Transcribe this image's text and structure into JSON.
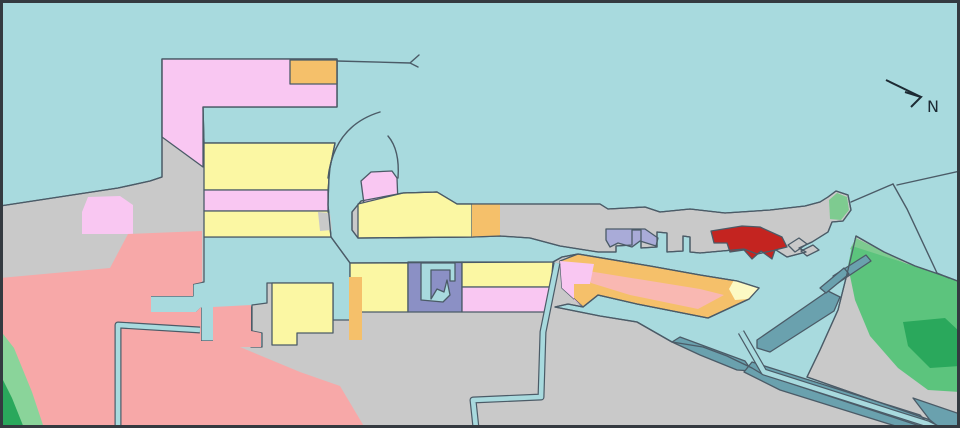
{
  "map": {
    "type": "harbor-zoning-map",
    "compass": {
      "label": "N",
      "shaft_d": "M886,80 L921,97",
      "head_d": "M905,92 L921,97 L911,107",
      "label_x": 927,
      "label_y": 112
    },
    "palette": {
      "water": "#a8dade",
      "land": "#c9c9c9",
      "outline": "#4b5b67",
      "frame": "#343a40",
      "pink": "#f9c7f2",
      "salmon": "#f7a8a8",
      "salmon_light": "#f9b8b2",
      "yellow": "#fbf7a3",
      "yellow_pale": "#fcf9c4",
      "orange": "#f5c06a",
      "slate": "#8b90c5",
      "purple": "#a9abd8",
      "red": "#c42420",
      "teal": "#6aa1ae",
      "green_light": "#8ad49a",
      "green_med": "#5cc47d",
      "green_dark": "#2aa85c",
      "green_strip": "#7ecb90",
      "north_ink": "#1d2a33"
    },
    "regions": [
      {
        "name": "mainland-west",
        "fill": "land",
        "stroke": true,
        "points": "0,206 118,188 150,181 162,177 162,59 337,59 337,107 203,107 204,143 335,143 329,172 328,205 331,237 350,263 553,262 562,257 578,254 650,266 700,275 737,281 759,288 749,299 708,318 637,304 598,295 583,307 568,304 555,307 600,316 637,322 672,342 703,347 727,356 752,368 762,374 926,428 0,428"
      },
      {
        "name": "north-pier",
        "fill": "land",
        "stroke": true,
        "points": "352,230 352,212 361,201 403,193 437,192 457,204 600,204 608,209 645,207 660,212 690,209 725,213 770,210 805,206 820,202 828,197 836,191 848,195 851,210 843,221 832,222 828,232 812,242 799,248 806,252 787,257 776,250 757,254 744,249 700,253 690,252 690,237 683,236 683,251 667,252 667,233 657,232 657,247 641,248 641,230 632,230 632,245 616,246 616,252 598,252 560,246 530,238 500,236 473,237 358,238"
      },
      {
        "name": "islet-east-1",
        "fill": "land",
        "stroke": true,
        "points": "788,245 799,238 807,244 795,252"
      },
      {
        "name": "islet-east-2",
        "fill": "land",
        "stroke": true,
        "points": "801,251 813,245 819,250 807,256"
      },
      {
        "name": "land-southeast",
        "fill": "land",
        "stroke": true,
        "points": "856,236 884,252 915,266 947,277 960,282 960,428 940,428 930,420 807,377 820,350 838,310 848,270"
      },
      {
        "name": "pier-head-pink-cap",
        "fill": "pink",
        "stroke": true,
        "points": "364,204 361,181 371,172 392,171 397,178 398,204"
      },
      {
        "name": "inner-basin-water",
        "fill": "water",
        "stroke": true,
        "points": "204,237 331,237 350,263 350,320 333,320 333,283 267,283 267,303 252,305 252,331 262,333 262,347 251,347 251,307 214,308 214,341 201,341 201,308 196,313 150,313 150,296 193,296 193,284 204,282"
      },
      {
        "name": "zone-pink-gamma",
        "fill": "pink",
        "stroke": true,
        "points": "162,59 337,59 337,107 203,107 203,167 162,137"
      },
      {
        "name": "zone-orange-top",
        "fill": "orange",
        "stroke": true,
        "points": "290,60 337,60 337,84 290,84"
      },
      {
        "name": "zone-yellow-band-1",
        "fill": "yellow",
        "stroke": true,
        "points": "204,143 335,143 330,168 328,190 204,190"
      },
      {
        "name": "zone-pink-band",
        "fill": "pink",
        "stroke": true,
        "points": "204,190 328,190 328,211 204,211"
      },
      {
        "name": "zone-yellow-band-2",
        "fill": "yellow",
        "stroke": true,
        "points": "204,211 328,211 331,237 204,237"
      },
      {
        "name": "gray-wedge-small",
        "fill": "land",
        "stroke": false,
        "points": "318,212 330,213 332,230 320,231"
      },
      {
        "name": "zone-pink-patch-west",
        "fill": "pink",
        "stroke": false,
        "points": "88,197 120,196 133,205 133,234 82,234 82,212"
      },
      {
        "name": "zone-salmon-main",
        "fill": "salmon",
        "stroke": false,
        "points": "0,278 110,268 128,234 202,231 202,282 193,284 193,296 151,296 151,312 196,312 201,307 201,341 213,341 213,307 251,305 251,331 261,333 261,347 240,347 300,372 340,386 365,428 0,428"
      },
      {
        "name": "green-hill-sw-light",
        "fill": "green_light",
        "stroke": false,
        "points": "0,330 14,348 32,392 44,428 0,428"
      },
      {
        "name": "green-hill-sw-dark",
        "fill": "green_dark",
        "stroke": false,
        "points": "0,374 12,398 24,428 0,428"
      },
      {
        "name": "zone-yellow-block-a",
        "fill": "yellow",
        "stroke": true,
        "points": "272,283 333,283 333,333 297,333 297,345 272,345"
      },
      {
        "name": "zone-yellow-block-c",
        "fill": "yellow",
        "stroke": true,
        "points": "350,263 408,263 408,312 350,312"
      },
      {
        "name": "zone-orange-strip",
        "fill": "orange",
        "stroke": false,
        "points": "349,277 362,277 362,340 349,340"
      },
      {
        "name": "zone-slate-block",
        "fill": "slate",
        "stroke": true,
        "points": "408,262 462,262 462,312 408,312"
      },
      {
        "name": "slate-dock-notch-water",
        "fill": "water",
        "stroke": true,
        "points": "421,263 455,263 455,281 450,281 450,270 431,270 431,299 437,289 444,292 447,280 450,295 443,302 421,300"
      },
      {
        "name": "zone-yellow-block-e",
        "fill": "yellow",
        "stroke": true,
        "points": "462,262 553,262 551,287 462,287"
      },
      {
        "name": "zone-pink-block-f",
        "fill": "pink",
        "stroke": true,
        "points": "462,287 551,287 547,312 462,312"
      },
      {
        "name": "diagonal-pier-orange",
        "fill": "orange",
        "stroke": true,
        "points": "560,261 578,254 650,266 700,275 737,281 759,288 749,299 708,318 637,304 598,295 583,307 562,288"
      },
      {
        "name": "diagonal-pier-salmon",
        "fill": "salmon_light",
        "stroke": false,
        "points": "588,271 700,289 724,295 698,309 630,295 591,283"
      },
      {
        "name": "diagonal-pier-pink-end",
        "fill": "pink",
        "stroke": false,
        "points": "560,261 594,264 590,284 574,284 574,300 583,307 562,288"
      },
      {
        "name": "diagonal-pier-yellow-tip",
        "fill": "yellow_pale",
        "stroke": false,
        "points": "734,280 759,288 749,299 735,300 729,289"
      },
      {
        "name": "north-pier-yellow",
        "fill": "yellow",
        "stroke": true,
        "points": "358,204 403,193 437,192 457,204 472,204 472,237 358,238"
      },
      {
        "name": "north-pier-orange",
        "fill": "orange",
        "stroke": false,
        "points": "472,204 500,204 500,236 472,237"
      },
      {
        "name": "zone-purple-docks",
        "fill": "purple",
        "stroke": true,
        "points": "606,229 645,229 658,238 656,246 640,241 632,247 618,243 610,247 606,240"
      },
      {
        "name": "zone-red-terminal",
        "fill": "red",
        "stroke": true,
        "points": "711,231 742,226 760,227 782,237 787,247 775,250 772,259 761,251 752,259 744,250 730,252 727,243 714,243"
      },
      {
        "name": "green-spit-strip",
        "fill": "green_strip",
        "stroke": false,
        "points": "830,219 829,200 837,193 847,197 849,210 841,220"
      },
      {
        "name": "green-strip-ne-coast",
        "fill": "green_strip",
        "stroke": false,
        "points": "856,238 905,263 896,273 850,249"
      },
      {
        "name": "green-hill-se-med",
        "fill": "green_med",
        "stroke": false,
        "points": "852,246 905,263 947,277 960,283 960,392 928,390 898,368 870,336 855,300 848,266"
      },
      {
        "name": "green-hill-se-dark",
        "fill": "green_dark",
        "stroke": false,
        "points": "903,322 945,318 960,332 960,366 930,368 908,346"
      },
      {
        "name": "teal-revetment-wedge",
        "fill": "teal",
        "stroke": true,
        "points": "672,342 680,337 745,361 752,371 737,370 700,355"
      },
      {
        "name": "teal-breakwater-band",
        "fill": "teal",
        "stroke": true,
        "points": "757,340 828,291 840,297 834,311 770,352 757,348"
      },
      {
        "name": "teal-finger-pier-1",
        "fill": "teal",
        "stroke": true,
        "points": "833,276 866,255 871,261 838,283"
      },
      {
        "name": "teal-finger-pier-2",
        "fill": "teal",
        "stroke": true,
        "points": "820,288 844,268 849,274 826,293"
      },
      {
        "name": "teal-canal-bank-south",
        "fill": "teal",
        "stroke": true,
        "points": "752,362 920,415 932,428 902,428 780,390 744,372"
      },
      {
        "name": "teal-corner-se",
        "fill": "teal",
        "stroke": true,
        "points": "913,398 960,414 960,428 936,428"
      }
    ],
    "restroke": [
      {
        "name": "mainland-west-coastline",
        "ref": "mainland-west"
      },
      {
        "name": "north-pier-coastline",
        "ref": "north-pier"
      },
      {
        "name": "land-southeast-coastline",
        "ref": "land-southeast"
      }
    ],
    "canals": [
      {
        "name": "canal-south-central",
        "d": "M557,263 L543,332 L541,397 L473,400 L476,428"
      },
      {
        "name": "canal-west",
        "d": "M118,428 L118,325 L200,330"
      },
      {
        "name": "canal-southeast",
        "d": "M741,332 L764,372 L928,424 L936,428"
      }
    ],
    "lines": [
      {
        "name": "breakwater-line-north",
        "d": "M337,61 L410,63 M419,55 L410,63 L418,67"
      },
      {
        "name": "harbor-entrance-arc-outer",
        "d": "M380,112 Q334,126 328,178"
      },
      {
        "name": "harbor-entrance-arc-inner",
        "d": "M388,136 Q400,150 398,178"
      },
      {
        "name": "breakwater-line-ne-1",
        "d": "M851,202 L893,184"
      },
      {
        "name": "breakwater-line-ne-2",
        "d": "M893,184 L907,209 L937,273 L949,278"
      },
      {
        "name": "breakwater-line-ne-3",
        "d": "M897,185 L960,171"
      }
    ]
  }
}
